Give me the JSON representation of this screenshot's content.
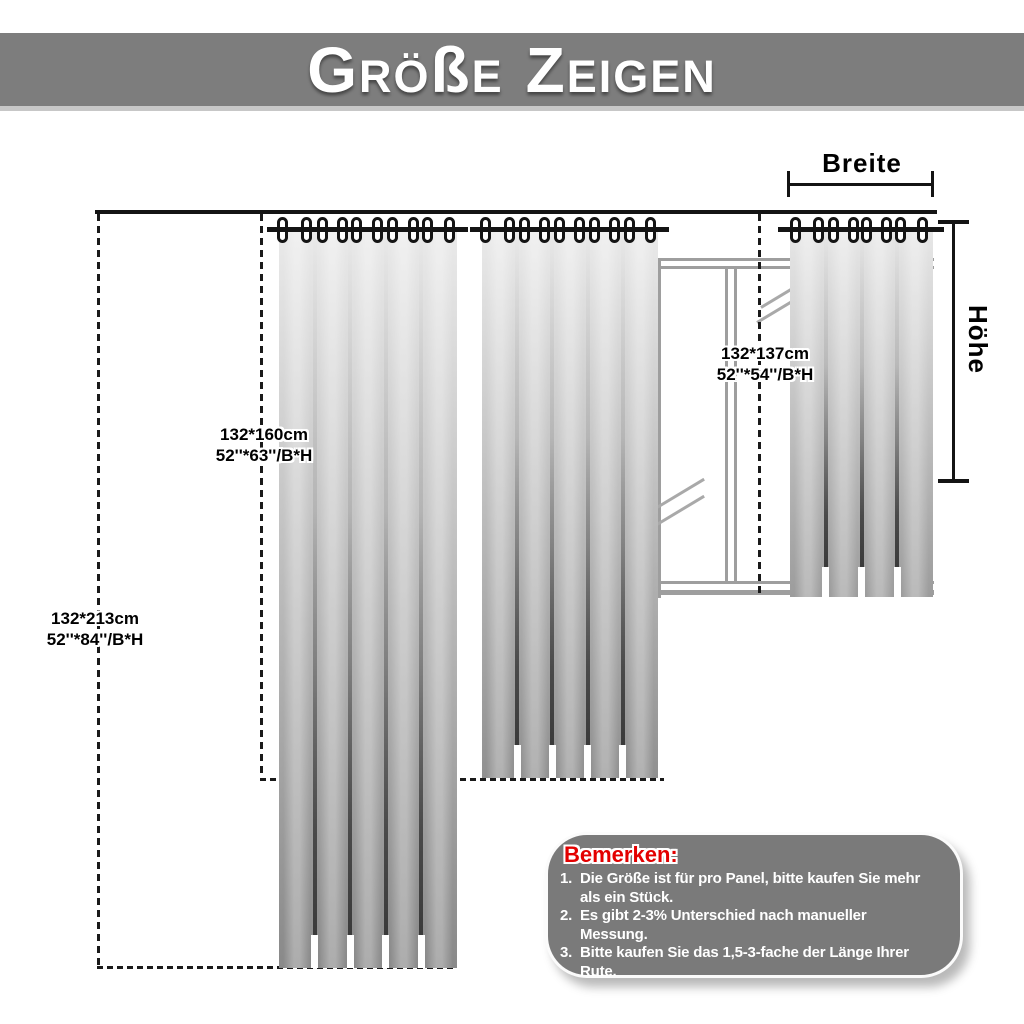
{
  "header": {
    "title": "Größe Zeigen",
    "title_segments": [
      {
        "text": "G",
        "large": true,
        "word_start": false
      },
      {
        "text": "RÖ",
        "large": false,
        "word_start": false
      },
      {
        "text": "ß",
        "large": true,
        "word_start": false
      },
      {
        "text": "E",
        "large": false,
        "word_start": false
      },
      {
        "text": "Z",
        "large": true,
        "word_start": true
      },
      {
        "text": "EIGEN",
        "large": false,
        "word_start": false
      }
    ]
  },
  "measurements": {
    "width_label": "Breite",
    "height_label": "Höhe"
  },
  "panels": [
    {
      "id": "213",
      "size_cm": "132*213cm",
      "size_inches": "52''*84''/B*H"
    },
    {
      "id": "160",
      "size_cm": "132*160cm",
      "size_inches": "52''*63''/B*H"
    },
    {
      "id": "137",
      "size_cm": "132*137cm",
      "size_inches": "52''*54''/B*H"
    }
  ],
  "notes": {
    "title": "Bemerken:",
    "items": [
      {
        "num": "1.",
        "lines": [
          "Die Größe ist für pro Panel, bitte kaufen Sie mehr",
          "als ein Stück."
        ]
      },
      {
        "num": "2.",
        "lines": [
          "Es gibt 2-3% Unterschied nach manueller",
          "Messung."
        ]
      },
      {
        "num": "3.",
        "lines": [
          "Bitte kaufen Sie das 1,5-3-fache der Länge Ihrer",
          "Rute."
        ]
      }
    ]
  },
  "colors": {
    "banner_bg": "#7d7d7d",
    "banner_text": "#ffffff",
    "line": "#141414",
    "window_frame": "#9e9e9e",
    "curtain_light": "#eaeaea",
    "curtain_dark": "#8b8b8b",
    "notes_bg": "#7a7a7a",
    "notes_title": "#e30000",
    "notes_text": "#ffffff"
  }
}
